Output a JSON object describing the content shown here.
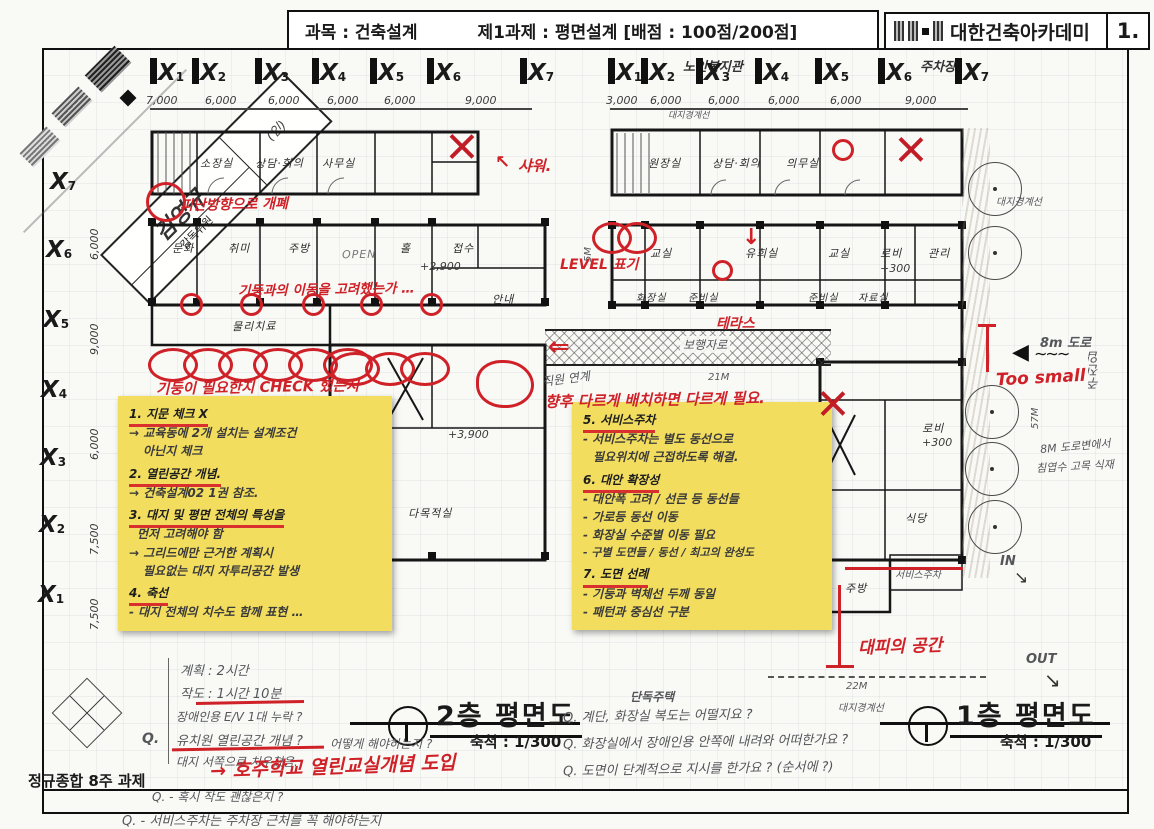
{
  "header": {
    "subject": "과목 : 건축설계",
    "task": "제1과제 : 평면설계 [배점 : 100점/200점]",
    "academy": "대한건축아카데미",
    "page": "1."
  },
  "stamp": {
    "name": "김영규",
    "role": "감독위원",
    "seal": "(인)"
  },
  "plans": {
    "glyph": "X",
    "left": {
      "title": "2층 평면도",
      "scale": "축척 : 1/300",
      "grid_top": [
        "1",
        "2",
        "3",
        "4",
        "5",
        "6",
        "7"
      ],
      "dims_top": [
        "7,000",
        "6,000",
        "6,000",
        "6,000",
        "6,000",
        "9,000"
      ],
      "grid_left": [
        "7",
        "6",
        "5",
        "4",
        "3",
        "2",
        "1"
      ],
      "dims_left": [
        "6,000",
        "9,000",
        "6,000",
        "7,500",
        "7,500"
      ],
      "rooms": {
        "r0": "소장실",
        "r1": "상담·회의",
        "r2": "사무실",
        "r3": "문화",
        "r4": "취미",
        "r5": "주방",
        "r6": "OPEN",
        "r7": "홀",
        "r8": "+2,900",
        "r9": "접수",
        "r10": "안내",
        "r11": "물리치료",
        "r12": "다목적실",
        "r13": "+3,900"
      }
    },
    "right": {
      "title": "1층 평면도",
      "scale": "축척 : 1/300",
      "building": "노인복지관",
      "parking": "주차장",
      "grid_top": [
        "1",
        "2",
        "3",
        "4",
        "5",
        "6",
        "7"
      ],
      "dims_top": [
        "3,000",
        "6,000",
        "6,000",
        "6,000",
        "6,000",
        "9,000"
      ],
      "rooms": {
        "r0": "원장실",
        "r1": "상담·회의",
        "r2": "의무실",
        "r3": "교실",
        "r4": "유희실",
        "r5": "교실",
        "r6": "로비",
        "r7": "+300",
        "r18": "관리",
        "r8": "화장실",
        "r9": "준비실",
        "r10": "준비실",
        "r11": "자료실",
        "r12": "보행자로",
        "r13": "로비",
        "r14": "+300",
        "r15": "식당",
        "r16": "주방",
        "r17": "서비스주차"
      }
    }
  },
  "sticky_left": [
    "1. 지문 체크 X",
    "→ 교육동에 2개 설치는 설계조건",
    "아닌지 체크",
    "2. 열린공간 개념.",
    "→ 건축설계02 1권 참조.",
    "3. 대지 및 평면 전체의 특성을",
    "먼저 고려해야 함",
    "→ 그리드에만 근거한 계획시",
    "필요없는 대지 자투리공간 발생",
    "4. 축선",
    "- 대지 전체의 치수도 함께 표현 …"
  ],
  "sticky_right": [
    "5. 서비스주차",
    "- 서비스주차는 별도 동선으로",
    "필요위치에 근접하도록 해결.",
    "6. 대안 확장성",
    "- 대안폭 고려 / 선큰 등 동선들",
    "- 가로등 동선 이동",
    "- 화장실 수준별 이동 필요",
    "- 구별 도면들 / 동선 / 최고의 완성도",
    "7. 도면 선례",
    "- 기둥과 벽체선 두께 동일",
    "- 패턴과 중심선 구분"
  ],
  "red_notes": {
    "evac": "피난방향으로 개폐",
    "shower": "샤워.",
    "column_q": "기둥과의 이동을 고려했는가 …",
    "column_check": "기둥이 필요한지 CHECK 했는지",
    "level": "LEVEL 표기",
    "terrace": "테라스",
    "future": "향후 다르게 배치하면 다르게 필요.",
    "too_small": "Too small",
    "refuge": "대피의 공간",
    "open_class": "→ 호주학교 열린교실개념 도입"
  },
  "pencil_notes": {
    "staff": "직원 연계",
    "d21": "21M",
    "d22": "22M",
    "d325": "32.5M",
    "d57": "57M",
    "d5": "5M",
    "house": "단독주택",
    "boundary": "대지경계선",
    "road": "8m 도로",
    "entry": "주진입",
    "trees_line1": "8M 도로변에서",
    "trees_line2": "침엽수 고목 식재",
    "in": "IN",
    "out": "OUT"
  },
  "questions_center": [
    "Q. 계단, 화장실 복도는 어떨지요 ?",
    "Q. 화장실에서 장애인용 안쪽에 내려와 어떠한가요 ?",
    "Q. 도면이 단계적으로 지시를 한가요 ? (순서에 ?)"
  ],
  "notes_bottom_left": {
    "plan_time": "계획 : 2시간",
    "draw_time": "작도 : 1시간 10분",
    "ev": "장애인용 E/V 1대 누락 ?",
    "q1": "Q.",
    "q1_text": "유치원 열린공간 개념 ?",
    "q1_tail": "어떻게 해야하는지 ?",
    "west": "대지 서쪽으로 치우쳤음.",
    "q2": "Q. - 혹시 작도 괜찮은지 ?",
    "q3": "Q. - 서비스주차는 주차장 근처를 꼭 해야하는지"
  },
  "footer": {
    "course": "정규종합 8주 과제"
  },
  "icons": {
    "arrow_left": "◀",
    "squiggle": "∼∼∼",
    "arrow_se": "↘",
    "arrow_dbl_left": "⇐",
    "arrow_down": "↓",
    "arrow_nw": "↖"
  }
}
